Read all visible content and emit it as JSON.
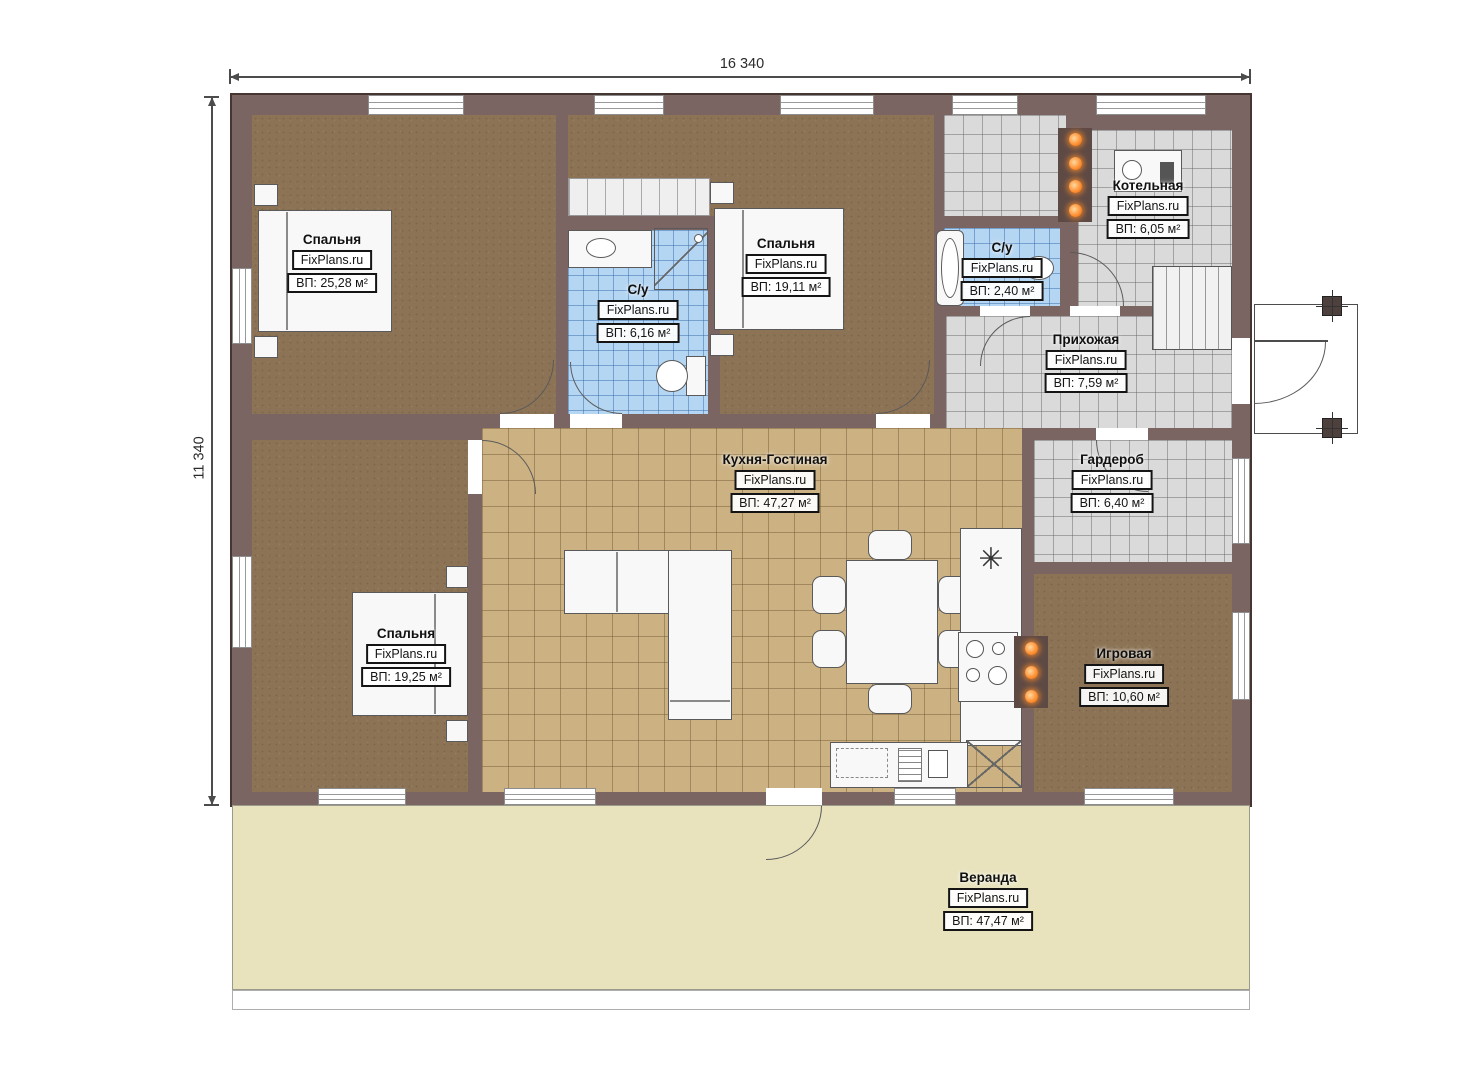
{
  "plan": {
    "width_dim": "16 340",
    "height_dim": "11 340",
    "brand": "FixPlans.ru"
  },
  "icons": {
    "cooktop": "✳"
  },
  "rooms": [
    {
      "id": "bedroom-1",
      "name": "Спальня",
      "area": "ВП: 25,28 м²"
    },
    {
      "id": "bathroom-1",
      "name": "С/у",
      "area": "ВП: 6,16 м²"
    },
    {
      "id": "bedroom-2",
      "name": "Спальня",
      "area": "ВП: 19,11 м²"
    },
    {
      "id": "bathroom-2",
      "name": "С/у",
      "area": "ВП: 2,40 м²"
    },
    {
      "id": "boiler-room",
      "name": "Котельная",
      "area": "ВП: 6,05 м²"
    },
    {
      "id": "hallway",
      "name": "Прихожая",
      "area": "ВП: 7,59 м²"
    },
    {
      "id": "wardrobe-room",
      "name": "Гардероб",
      "area": "ВП: 6,40 м²"
    },
    {
      "id": "kitchen-living",
      "name": "Кухня-Гостиная",
      "area": "ВП: 47,27 м²"
    },
    {
      "id": "bedroom-3",
      "name": "Спальня",
      "area": "ВП: 19,25 м²"
    },
    {
      "id": "playroom",
      "name": "Игровая",
      "area": "ВП: 10,60 м²"
    },
    {
      "id": "veranda",
      "name": "Веранда",
      "area": "ВП: 47,47 м²"
    }
  ],
  "colors": {
    "wall": "#7a6562",
    "floor_wood": "#8c7355",
    "floor_kitchen_tile": "#ccb283",
    "floor_bath_tile": "#b5d6f2",
    "floor_hall_tile": "#dadada",
    "veranda": "#e8e3bd",
    "radiator": "#ff8c2e"
  }
}
